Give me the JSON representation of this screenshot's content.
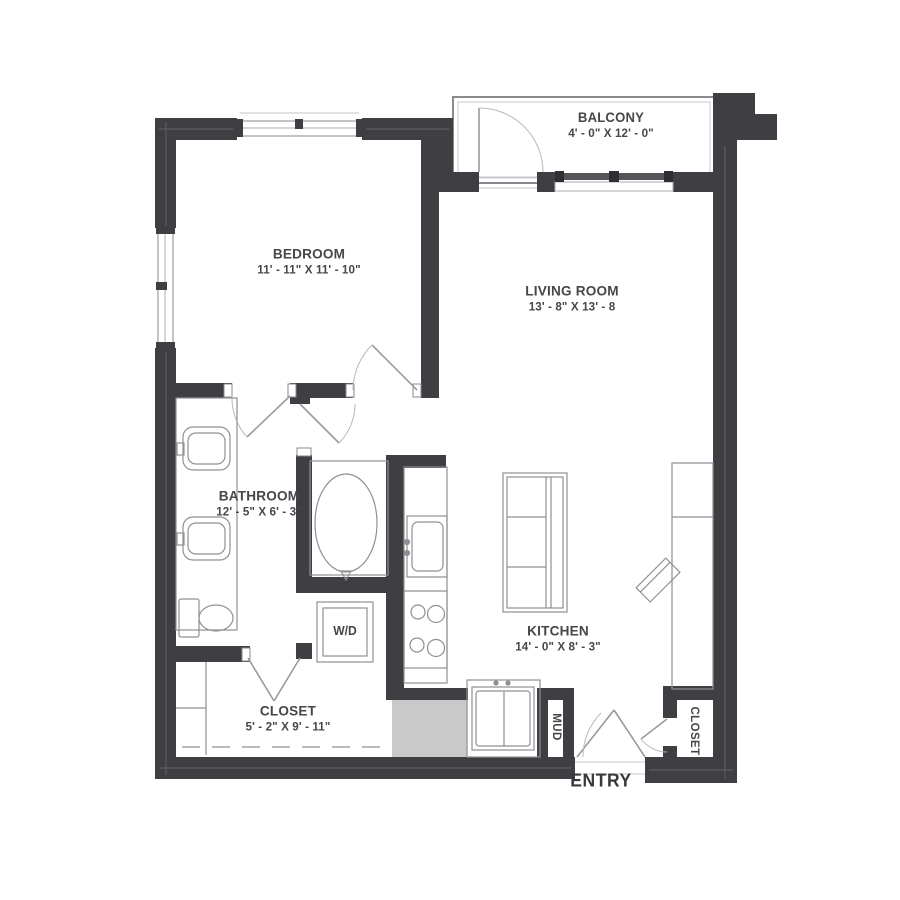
{
  "plan": {
    "rooms": [
      {
        "id": "bedroom",
        "name": "BEDROOM",
        "dims": "11' - 11\" X 11' - 10\""
      },
      {
        "id": "living_room",
        "name": "LIVING ROOM",
        "dims": "13' - 8\" X 13' - 8"
      },
      {
        "id": "balcony",
        "name": "BALCONY",
        "dims": "4' - 0\" X 12' - 0\""
      },
      {
        "id": "bathroom",
        "name": "BATHROOM",
        "dims": "12' - 5\" X 6' - 3\""
      },
      {
        "id": "kitchen",
        "name": "KITCHEN",
        "dims": "14' - 0\" X 8' - 3\""
      },
      {
        "id": "closet",
        "name": "CLOSET",
        "dims": "5' - 2\" X 9' - 11\""
      }
    ],
    "small_labels": {
      "washer_dryer": "W/D",
      "mud": "MUD",
      "entry_closet": "CLOSET",
      "entry": "ENTRY"
    },
    "colors": {
      "wall": "#3f3f43",
      "fixture_line": "#909094",
      "light_line": "#bbbbbf",
      "text": "#46464b",
      "entry_mat": "#c9c9c9",
      "slider_bar": "#55555a",
      "background": "#ffffff"
    }
  }
}
